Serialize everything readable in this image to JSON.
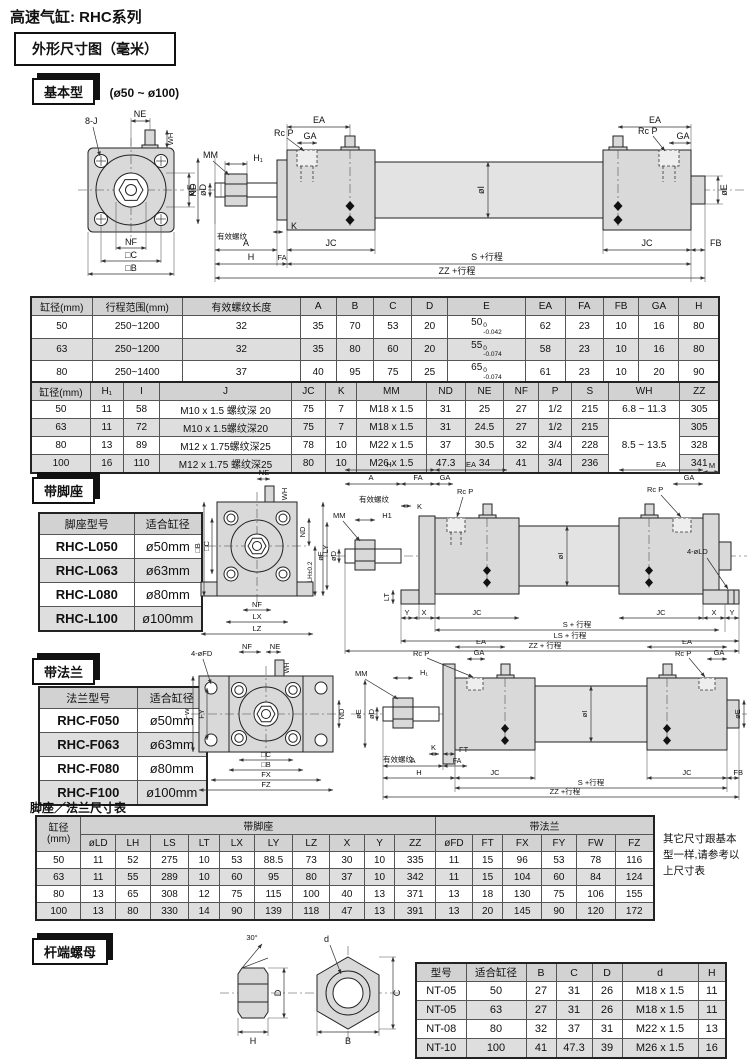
{
  "page": {
    "title": "高速气缸: RHC系列",
    "dim_box": "外形尺寸图（毫米）",
    "basic_tab": "基本型",
    "basic_range": "(ø50 ~ ø100)",
    "foot_tab": "带脚座",
    "flange_tab": "带法兰",
    "footflange_title": "脚座／法兰尺寸表",
    "nut_tab": "杆端螺母",
    "side_note": "其它尺寸跟基本\n型一样,请参考以\n上尺寸表"
  },
  "table1": {
    "headers": [
      "缸径(mm)",
      "行程范围(mm)",
      "有效螺纹长度",
      "A",
      "B",
      "C",
      "D",
      "E",
      "EA",
      "FA",
      "FB",
      "GA",
      "H"
    ],
    "rows": [
      [
        "50",
        "250~1200",
        "32",
        "35",
        "70",
        "53",
        "20",
        {
          "base": "50",
          "sup": "0",
          "sub": "-0.042"
        },
        "62",
        "23",
        "10",
        "16",
        "80"
      ],
      [
        "63",
        "250~1200",
        "32",
        "35",
        "80",
        "60",
        "20",
        {
          "base": "55",
          "sup": "0",
          "sub": "-0.074"
        },
        "58",
        "23",
        "10",
        "16",
        "80"
      ],
      [
        "80",
        "250~1400",
        "37",
        "40",
        "95",
        "75",
        "25",
        {
          "base": "65",
          "sup": "0",
          "sub": "-0.074"
        },
        "61",
        "23",
        "10",
        "20",
        "90"
      ],
      [
        "100",
        "250~1500",
        "37",
        "40",
        "116",
        "90",
        "30",
        {
          "base": "80",
          "sup": "0",
          "sub": "-0.074"
        },
        "63",
        "25",
        "10",
        "20",
        "95"
      ]
    ]
  },
  "table2": {
    "headers": [
      "缸径(mm)",
      "H₁",
      "I",
      "J",
      "JC",
      "K",
      "MM",
      "ND",
      "NE",
      "NF",
      "P",
      "S",
      "WH",
      "ZZ"
    ],
    "rows": [
      [
        "50",
        "11",
        "58",
        "M10 x 1.5 螺纹深 20",
        "75",
        "7",
        "M18 x 1.5",
        "31",
        "25",
        "27",
        "1/2",
        "215",
        "6.8 ~ 11.3",
        "305"
      ],
      [
        "63",
        "11",
        "72",
        "M10 x 1.5螺纹深20",
        "75",
        "7",
        "M18 x 1.5",
        "31",
        "24.5",
        "27",
        "1/2",
        "215",
        {
          "v": "8.5 ~ 13.5",
          "rowspan": 3,
          "cls": "merged"
        },
        "305"
      ],
      [
        "80",
        "13",
        "89",
        "M12 x 1.75螺纹深25",
        "78",
        "10",
        "M22 x 1.5",
        "37",
        "30.5",
        "32",
        "3/4",
        "228",
        null,
        "328"
      ],
      [
        "100",
        "16",
        "110",
        "M12 x 1.75 螺纹深25",
        "80",
        "10",
        "M26 x 1.5",
        "47.3",
        "34",
        "41",
        "3/4",
        "236",
        null,
        "341"
      ]
    ]
  },
  "foot_table": {
    "headers": [
      "脚座型号",
      "适合缸径"
    ],
    "rows": [
      [
        "RHC-L050",
        "ø50mm"
      ],
      [
        "RHC-L063",
        "ø63mm"
      ],
      [
        "RHC-L080",
        "ø80mm"
      ],
      [
        "RHC-L100",
        "ø100mm"
      ]
    ]
  },
  "flange_table": {
    "headers": [
      "法兰型号",
      "适合缸径"
    ],
    "rows": [
      [
        "RHC-F050",
        "ø50mm"
      ],
      [
        "RHC-F063",
        "ø63mm"
      ],
      [
        "RHC-F080",
        "ø80mm"
      ],
      [
        "RHC-F100",
        "ø100mm"
      ]
    ]
  },
  "footflange_table": {
    "col1": "缸径\n(mm)",
    "group": [
      {
        "label": "带脚座",
        "span": 10
      },
      {
        "label": "带法兰",
        "span": 6
      }
    ],
    "headers": [
      "øLD",
      "LH",
      "LS",
      "LT",
      "LX",
      "LY",
      "LZ",
      "X",
      "Y",
      "ZZ",
      "øFD",
      "FT",
      "FX",
      "FY",
      "FW",
      "FZ"
    ],
    "rows": [
      [
        "50",
        "11",
        "52",
        "275",
        "10",
        "53",
        "88.5",
        "73",
        "30",
        "10",
        "335",
        "11",
        "15",
        "96",
        "53",
        "78",
        "116"
      ],
      [
        "63",
        "11",
        "55",
        "289",
        "10",
        "60",
        "95",
        "80",
        "37",
        "10",
        "342",
        "11",
        "15",
        "104",
        "60",
        "84",
        "124"
      ],
      [
        "80",
        "13",
        "65",
        "308",
        "12",
        "75",
        "115",
        "100",
        "40",
        "13",
        "371",
        "13",
        "18",
        "130",
        "75",
        "106",
        "155"
      ],
      [
        "100",
        "13",
        "80",
        "330",
        "14",
        "90",
        "139",
        "118",
        "47",
        "13",
        "391",
        "13",
        "20",
        "145",
        "90",
        "120",
        "172"
      ]
    ]
  },
  "nut_table": {
    "headers": [
      "型号",
      "适合缸径",
      "B",
      "C",
      "D",
      "d",
      "H"
    ],
    "rows": [
      [
        "NT-05",
        "50",
        "27",
        "31",
        "26",
        "M18 x 1.5",
        "11"
      ],
      [
        "NT-05",
        "63",
        "27",
        "31",
        "26",
        "M18 x 1.5",
        "11"
      ],
      [
        "NT-08",
        "80",
        "32",
        "37",
        "31",
        "M22 x 1.5",
        "13"
      ],
      [
        "NT-10",
        "100",
        "41",
        "47.3",
        "39",
        "M26 x 1.5",
        "16"
      ]
    ]
  },
  "dim": {
    "basic_front": {
      "bolts": "8-J",
      "ne": "NE",
      "wh": "WH",
      "nd": "ND",
      "nf": "NF",
      "sqc": "□C",
      "sqb": "□B"
    },
    "basic_side": {
      "mm": "MM",
      "h1": "H₁",
      "rcp": "Rc P",
      "ga": "GA",
      "ea": "EA",
      "oe": "øE",
      "od": "øD",
      "thread": "有效螺纹",
      "k": "K",
      "a": "A",
      "fa": "FA",
      "h": "H",
      "jc": "JC",
      "oi": "øI",
      "fb": "FB",
      "s": "S +行程",
      "zz": "ZZ +行程"
    },
    "foot_front": {
      "ne": "NE",
      "wh": "WH",
      "nd": "ND",
      "sqb": "□B",
      "sqc": "□C",
      "ly": "LY",
      "lh": "LH±0.2",
      "nf": "NF",
      "lx": "LX",
      "lz": "LZ"
    },
    "foot_side": {
      "h": "H",
      "a": "A",
      "fa": "FA",
      "ga": "GA",
      "ea": "EA",
      "rcp": "Rc P",
      "m": "M",
      "thread": "有效螺纹",
      "k": "K",
      "mm": "MM",
      "h1": "H1",
      "oe": "øE",
      "od": "øD",
      "oi": "øI",
      "lt": "LT",
      "x": "X",
      "y": "Y",
      "jc": "JC",
      "lod": "4-øLD",
      "s": "S + 行程",
      "ls": "LS + 行程",
      "zz": "ZZ + 行程"
    },
    "flange_front": {
      "fd": "4-øFD",
      "nf": "NF",
      "ne": "NE",
      "wh": "WH",
      "fw": "FW",
      "fy": "FY",
      "nd": "ND",
      "sqc": "□C",
      "sqb": "□B",
      "fx": "FX",
      "fz": "FZ"
    },
    "flange_side": {
      "mm": "MM",
      "h1": "H₁",
      "rcp": "Rc P",
      "ga": "GA",
      "ea": "EA",
      "oe": "øE",
      "od": "øD",
      "oi": "øI",
      "thread": "有效螺纹",
      "k": "K",
      "ft": "FT",
      "a": "A",
      "fa": "FA",
      "h": "H",
      "jc": "JC",
      "fb": "FB",
      "s": "S +行程",
      "zz": "ZZ +行程"
    },
    "nut": {
      "angle": "30°",
      "d": "D",
      "h": "H",
      "thread": "d",
      "c": "C",
      "b": "B"
    }
  }
}
